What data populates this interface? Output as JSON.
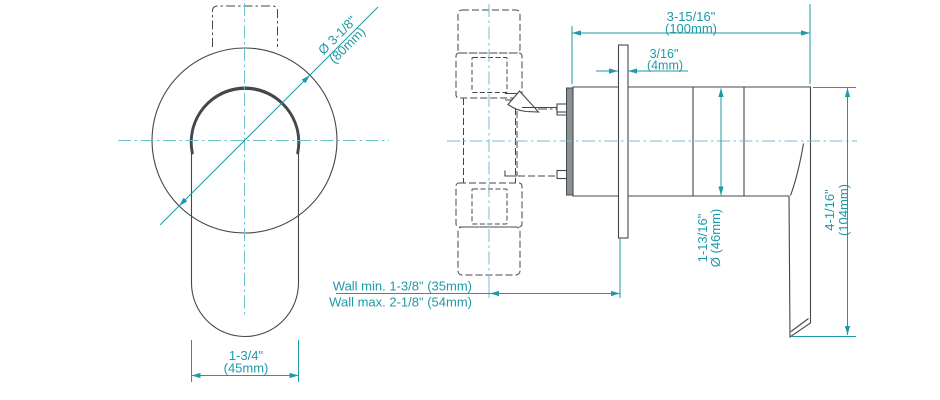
{
  "drawing": {
    "type": "technical-dimension-drawing",
    "views": {
      "front": "handle-front-view",
      "side": "valve-side-view"
    },
    "dimensions": {
      "escutcheon_diameter": {
        "label": "Ø 3-1/8\"",
        "metric": "(80mm)"
      },
      "trim_length": {
        "label": "3-15/16\"",
        "metric": "(100mm)"
      },
      "plate_thickness": {
        "label": "3/16\"",
        "metric": "(4mm)"
      },
      "wall_min": "Wall min. 1-3/8\" (35mm)",
      "wall_max": "Wall max. 2-1/8\" (54mm)",
      "handle_width": {
        "label": "1-3/4\"",
        "metric": "(45mm)"
      },
      "body_diameter": {
        "label": "1-13/16\"",
        "metric": "Ø (46mm)"
      },
      "overall_height": {
        "label": "4-1/16\"",
        "metric": "(104mm)"
      }
    },
    "colors": {
      "dimension": "#1d9aa8",
      "centerline": "#6cc3cd",
      "line": "#43474e",
      "background": "#ffffff"
    }
  }
}
